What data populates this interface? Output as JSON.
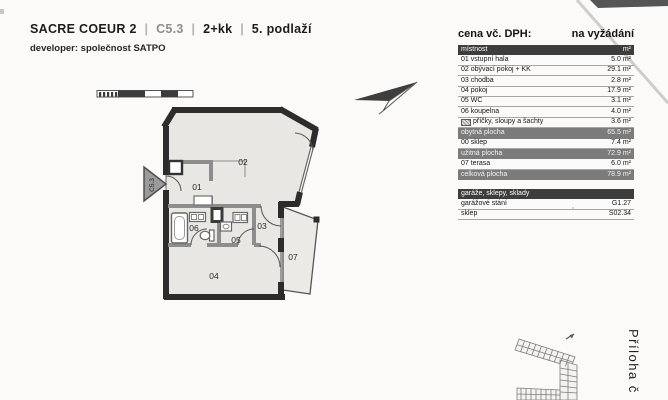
{
  "header": {
    "project": "SACRE COEUR 2",
    "unit_code": "C5.3",
    "disposition": "2+kk",
    "floor": "5. podlaží",
    "separator": "|",
    "developer": "developer: společnost SATPO"
  },
  "price": {
    "label": "cena vč. DPH:",
    "value": "na vyžádání"
  },
  "area_table": {
    "columns": {
      "room": "místnost",
      "unit": "m²"
    },
    "rows": [
      {
        "label": "01 vstupní hala",
        "value": "5.0 m²"
      },
      {
        "label": "02 obývací pokoj + KK",
        "value": "29.1 m²"
      },
      {
        "label": "03 chodba",
        "value": "2.8 m²"
      },
      {
        "label": "04 pokoj",
        "value": "17.9 m²"
      },
      {
        "label": "05 WC",
        "value": "3.1 m²"
      },
      {
        "label": "06 koupelna",
        "value": "4.0 m²"
      },
      {
        "label": "příčky, sloupy a šachty",
        "value": "3.6 m²",
        "icon": "hatch-swatch"
      },
      {
        "label": "obytná plocha",
        "value": "65.5 m²",
        "summary": true
      },
      {
        "label": "00 sklep",
        "value": "7.4 m²"
      },
      {
        "label": "užitná plocha",
        "value": "72.9 m²",
        "summary": true
      },
      {
        "label": "07 terasa",
        "value": "6.0 m²"
      },
      {
        "label": "celková plocha",
        "value": "78.9 m²",
        "summary": true
      }
    ],
    "garage_section": {
      "header": "garáže, sklepy, sklady",
      "rows": [
        {
          "label": "garážové stání",
          "value": "G1.27"
        },
        {
          "label": "sklep",
          "value": "S02.34"
        }
      ]
    }
  },
  "floor_plan": {
    "unit_marker": "C5.3",
    "room_labels": [
      "01",
      "02",
      "03",
      "04",
      "05",
      "06",
      "07"
    ]
  },
  "attachment": {
    "label": "Příloha č"
  },
  "colors": {
    "wall": "#2c2c2c",
    "floor_fill": "#e8e7e4",
    "partition": "#8d8d8d",
    "table_header_bg": "#3d3d3d",
    "summary_row_bg": "#7b7b7b"
  }
}
